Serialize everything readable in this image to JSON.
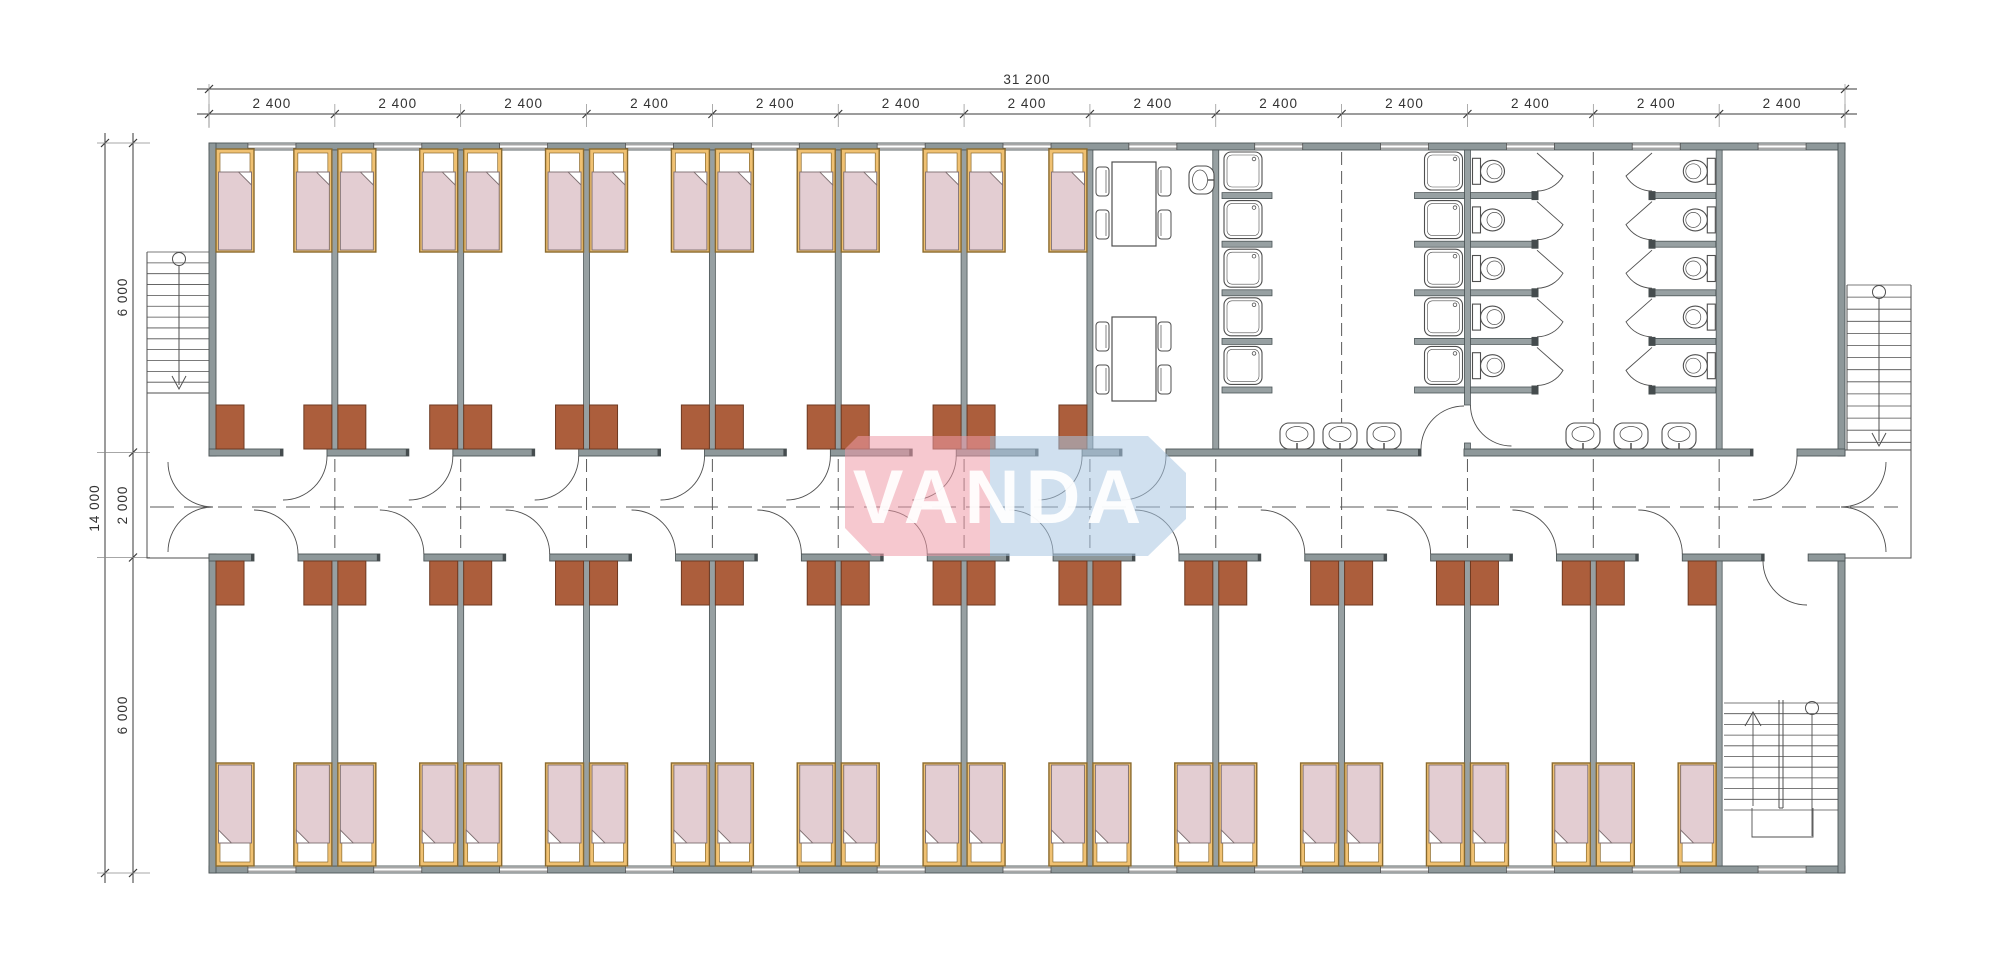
{
  "page": {
    "background": "#ffffff",
    "width": 2000,
    "height": 977
  },
  "watermark": {
    "text": "VANDA",
    "red_panel_color": "#EE9AA7",
    "blue_panel_color": "#A9C7E2",
    "text_color": "#FFFFFF"
  },
  "dimensions": {
    "top_total_label": "31 200",
    "top_module_labels": [
      "2 400",
      "2 400",
      "2 400",
      "2 400",
      "2 400",
      "2 400",
      "2 400",
      "2 400",
      "2 400",
      "2 400",
      "2 400",
      "2 400",
      "2 400"
    ],
    "left_total_label": "14 000",
    "left_zone_labels": [
      "6 000",
      "2 000",
      "6 000"
    ]
  },
  "plan": {
    "modules": 13,
    "module_width_mm": 2400,
    "building_width_mm": 31200,
    "building_depth_mm": 14000,
    "corridor_depth_mm": 2000,
    "room_zone_depth_mm": 6000,
    "bedroom_bays_top": 7,
    "bedroom_bays_bottom": 12,
    "beds_top_row": 14,
    "beds_bottom_row": 24,
    "desks": 38,
    "shower_stalls": 10,
    "toilet_stalls": 10,
    "wash_basins": 6,
    "canteen_tables": 2,
    "canteen_chairs": 8,
    "canteen_sinks": 1,
    "exterior_staircases": 2,
    "interior_staircases": 1
  },
  "colors": {
    "wall_fill": "#8E989A",
    "wall_edge": "#4C5557",
    "partition_fill": "#97A0A2",
    "stub_fill": "#454C4E",
    "bed_frame": "#F0C172",
    "bed_frame_edge": "#8A6A2E",
    "bed_blanket": "#E3CDD2",
    "bed_blanket_edge": "#7D6E70",
    "bed_pillow": "#FFFFFF",
    "desk_fill": "#AC5E3C",
    "desk_edge": "#6E3A22",
    "fixture_line": "#4F4F4F",
    "dim_line": "#3A3A3A",
    "dash_line": "#5A5A5A"
  }
}
